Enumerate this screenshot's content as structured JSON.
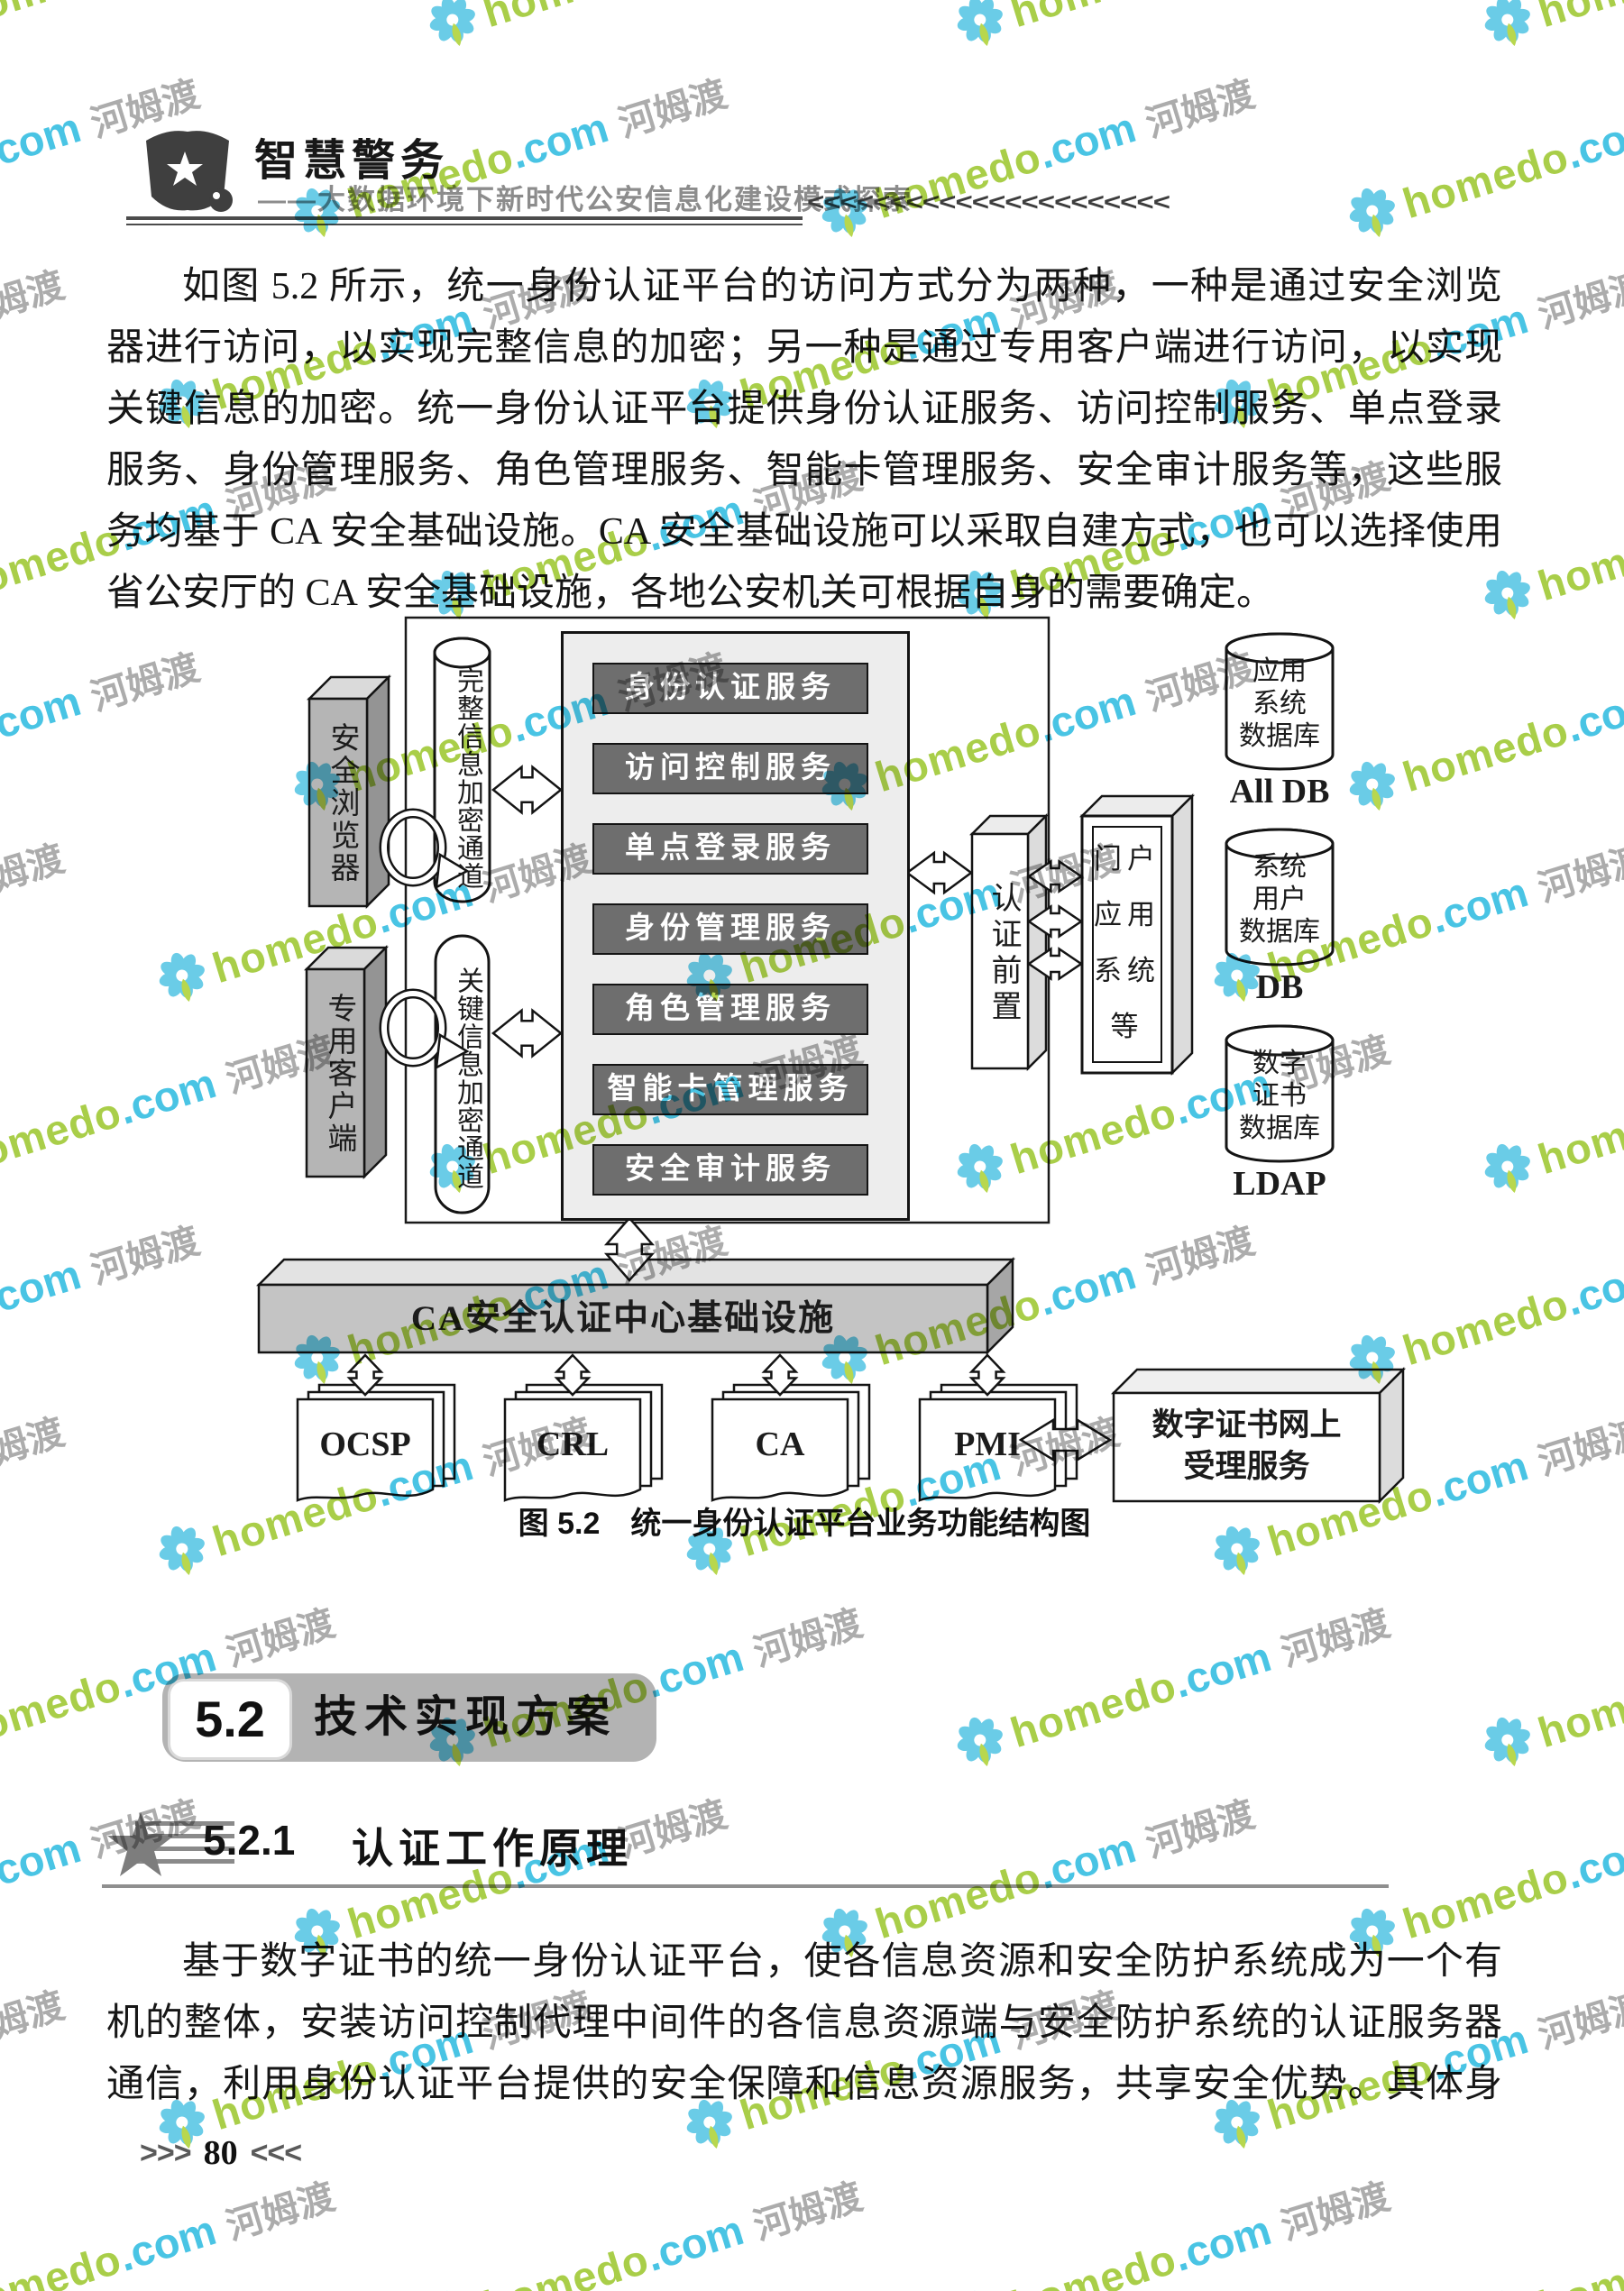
{
  "header": {
    "title": "智慧警务",
    "subtitle": "——大数据环境下新时代公安信息化建设模式探索",
    "chevrons_right": "<<<<<<<<<<<<<<<<<<<<<<"
  },
  "watermark": {
    "brand": "homedo",
    "domain": ".com",
    "cjk": "河姆渡"
  },
  "paragraph1": {
    "lines": [
      "如图 5.2 所示，统一身份认证平台的访问方式分为两种，一种是通过安全浏览",
      "器进行访问，以实现完整信息的加密；另一种是通过专用客户端进行访问，以实现",
      "关键信息的加密。统一身份认证平台提供身份认证服务、访问控制服务、单点登录",
      "服务、身份管理服务、角色管理服务、智能卡管理服务、安全审计服务等，这些服",
      "务均基于 CA 安全基础设施。CA 安全基础设施可以采取自建方式，也可以选择使用",
      "省公安厅的 CA 安全基础设施，各地公安机关可根据自身的需要确定。"
    ]
  },
  "diagram": {
    "left_boxes": [
      "安全浏览器",
      "专用客户端"
    ],
    "channels": [
      "完整信息加密通道",
      "关键信息加密通道"
    ],
    "services": [
      "身份认证服务",
      "访问控制服务",
      "单点登录服务",
      "身份管理服务",
      "角色管理服务",
      "智能卡管理服务",
      "安全审计服务"
    ],
    "auth_front": "认证前置",
    "portal_rows": [
      "门户",
      "应用",
      "系统",
      "等"
    ],
    "databases": [
      {
        "lines": [
          "应用",
          "系统",
          "数据库"
        ],
        "label": "All DB"
      },
      {
        "lines": [
          "系统",
          "用户",
          "数据库"
        ],
        "label": "DB"
      },
      {
        "lines": [
          "数字",
          "证书",
          "数据库"
        ],
        "label": "LDAP"
      }
    ],
    "ca_bar": "CA安全认证中心基础设施",
    "docs": [
      "OCSP",
      "CRL",
      "CA",
      "PMI"
    ],
    "online_service_lines": [
      "数字证书网上",
      "受理服务"
    ]
  },
  "caption": "图 5.2　统一身份认证平台业务功能结构图",
  "section": {
    "number": "5.2",
    "title": "技术实现方案"
  },
  "subsection": {
    "number": "5.2.1",
    "title": "认证工作原理"
  },
  "paragraph2": {
    "lines": [
      "基于数字证书的统一身份认证平台，使各信息资源和安全防护系统成为一个有",
      "机的整体，安装访问控制代理中间件的各信息资源端与安全防护系统的认证服务器",
      "通信，利用身份认证平台提供的安全保障和信息资源服务，共享安全优势。具体身"
    ]
  },
  "footer": {
    "left_arrows": ">>>",
    "page": "80",
    "right_arrows": "<<<"
  }
}
